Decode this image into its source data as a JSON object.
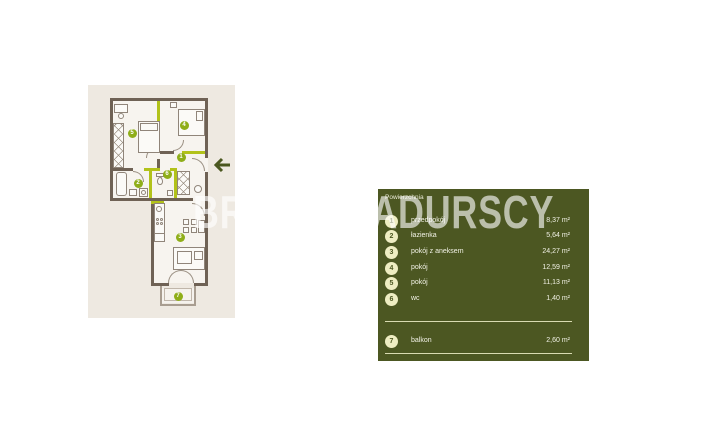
{
  "watermark_text": "BRACIA SADURSCY",
  "plan": {
    "badges": [
      "1",
      "2",
      "3",
      "4",
      "5",
      "6",
      "7"
    ],
    "entrance_arrow": "left"
  },
  "legend": {
    "header": "Powierzchnia",
    "rows": [
      {
        "num": "1",
        "label": "przedpokój",
        "area": "8,37 m²"
      },
      {
        "num": "2",
        "label": "łazienka",
        "area": "5,64 m²"
      },
      {
        "num": "3",
        "label": "pokój z aneksem",
        "area": "24,27 m²"
      },
      {
        "num": "4",
        "label": "pokój",
        "area": "12,59 m²"
      },
      {
        "num": "5",
        "label": "pokój",
        "area": "11,13 m²"
      },
      {
        "num": "6",
        "label": "wc",
        "area": "1,40 m²"
      }
    ],
    "balcony_row": {
      "num": "7",
      "label": "balkon",
      "area": "2,60 m²"
    }
  },
  "colors": {
    "panel_green": "#4c5722",
    "accent_green": "#b2c21a",
    "badge_cream": "#eeedc2",
    "badge_plan_green": "#8fae19",
    "wall_dark": "#6f6255",
    "backdrop_beige": "#eee9e1"
  }
}
